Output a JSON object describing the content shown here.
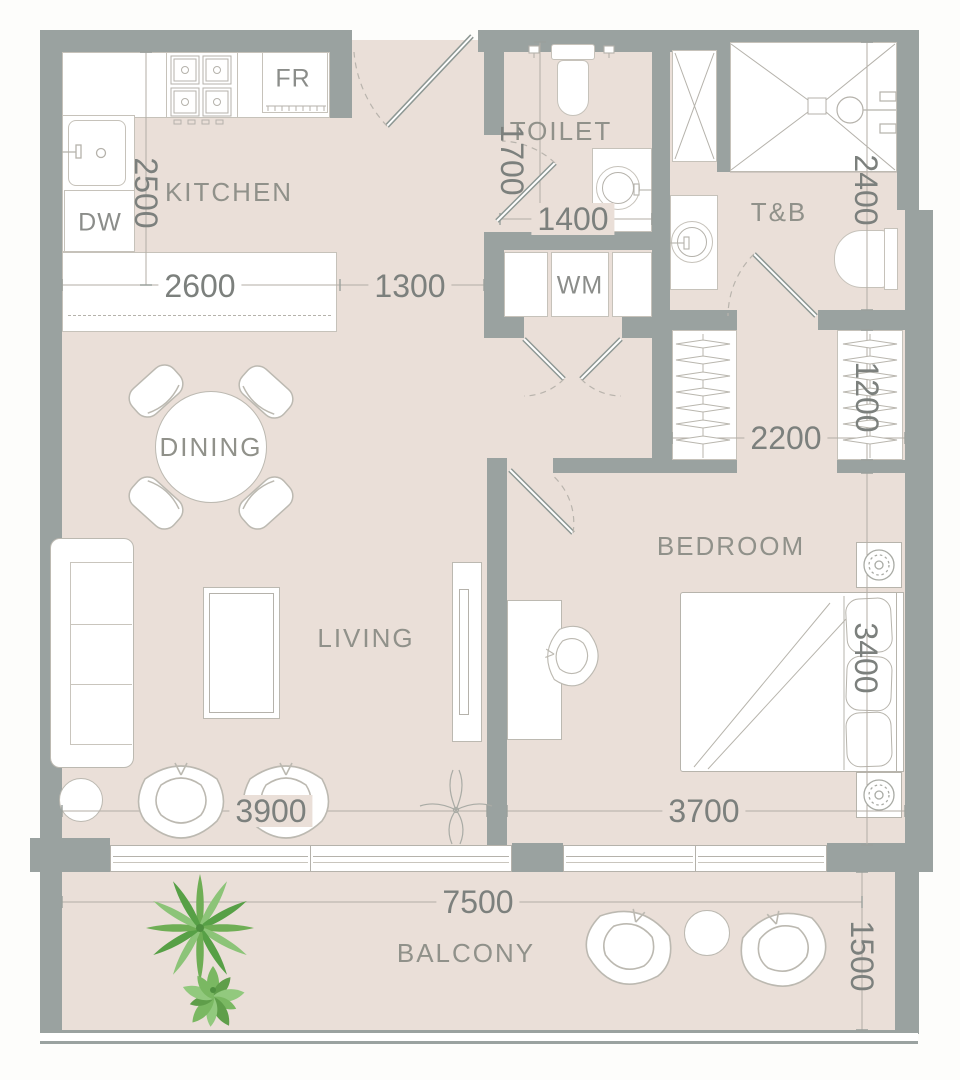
{
  "plan": {
    "rooms": {
      "kitchen": {
        "label": "KITCHEN"
      },
      "toilet": {
        "label": "TOILET"
      },
      "toilet_bath": {
        "label": "T&B"
      },
      "dining": {
        "label": "DINING"
      },
      "living": {
        "label": "LIVING"
      },
      "bedroom": {
        "label": "BEDROOM"
      },
      "balcony": {
        "label": "BALCONY"
      }
    },
    "appliances": {
      "fridge": {
        "label": "FR"
      },
      "dishwasher": {
        "label": "DW"
      },
      "washer": {
        "label": "WM"
      }
    },
    "dimensions": {
      "kitchen_depth": {
        "value": "2500"
      },
      "kitchen_counter": {
        "value": "2600"
      },
      "entry_corridor": {
        "value": "1300"
      },
      "toilet_depth": {
        "value": "1700"
      },
      "toilet_width": {
        "value": "1400"
      },
      "bath_depth": {
        "value": "2400"
      },
      "dressing_width": {
        "value": "2200"
      },
      "closet_depth": {
        "value": "1200"
      },
      "living_width": {
        "value": "3900"
      },
      "bedroom_width": {
        "value": "3700"
      },
      "bedroom_depth": {
        "value": "3400"
      },
      "balcony_width": {
        "value": "7500"
      },
      "balcony_depth": {
        "value": "1500"
      }
    },
    "colors": {
      "wall": "#9aa2a0",
      "floor": "#eadfd8",
      "fixture_outline": "#b5b2ab",
      "dimension_text": "#7c807d",
      "label_text": "#90918a",
      "plant_green": "#6fae55"
    }
  }
}
